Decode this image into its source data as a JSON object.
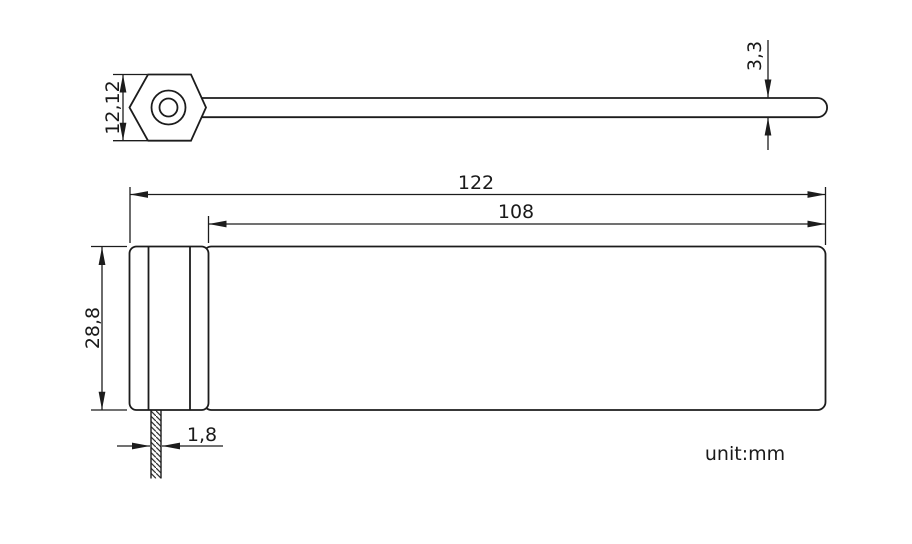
{
  "drawing": {
    "unit_label": "unit:mm",
    "dimensions": {
      "head_height": "12,12",
      "tail_thickness": "3,3",
      "total_length": "122",
      "strap_length": "108",
      "body_width": "28,8",
      "strap_thickness": "1,8"
    },
    "colors": {
      "line": "#1c1c1c",
      "text": "#1a1a1a",
      "background": "#ffffff"
    }
  }
}
